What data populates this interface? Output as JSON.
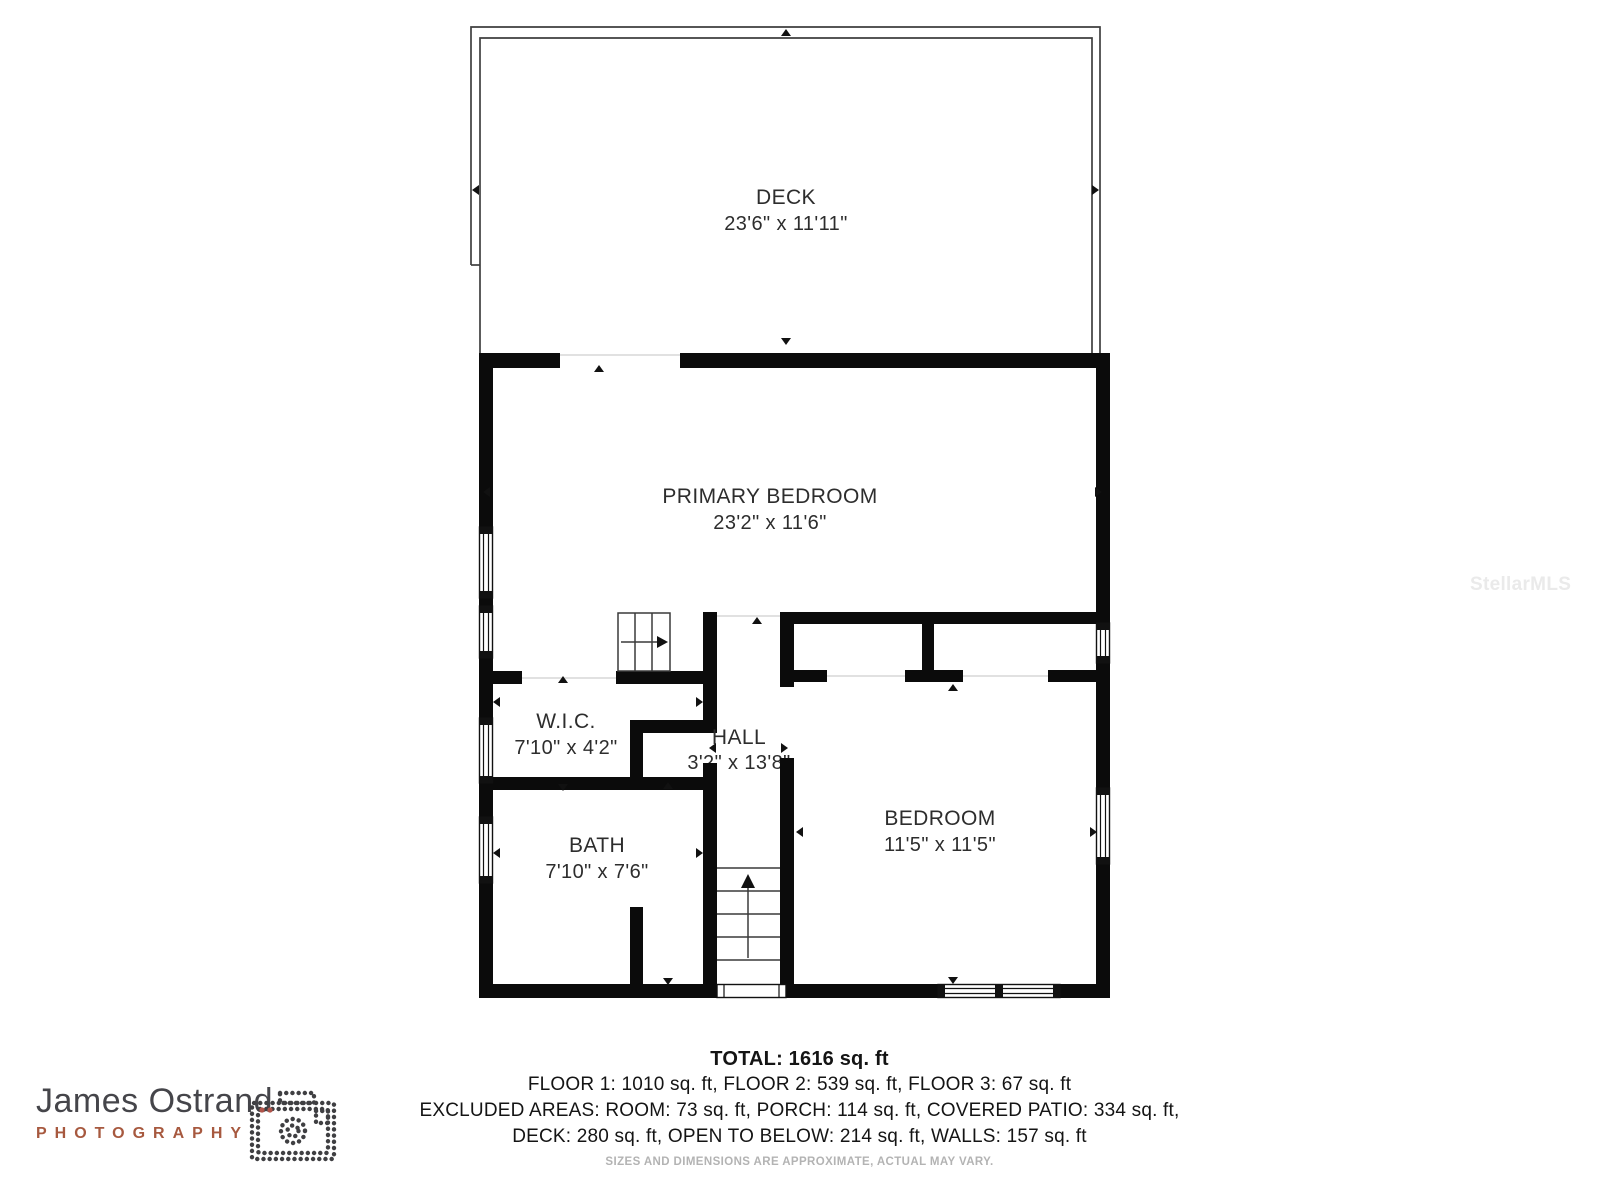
{
  "watermark": "StellarMLS",
  "plan": {
    "wall_color": "#0b0b0b",
    "rooms": [
      {
        "id": "deck",
        "name": "DECK",
        "dims": "23'6\" x 11'11\""
      },
      {
        "id": "primary-bedroom",
        "name": "PRIMARY BEDROOM",
        "dims": "23'2\" x 11'6\""
      },
      {
        "id": "wic",
        "name": "W.I.C.",
        "dims": "7'10\" x 4'2\""
      },
      {
        "id": "hall",
        "name": "HALL",
        "dims": "3'2\" x 13'8\""
      },
      {
        "id": "bath",
        "name": "BATH",
        "dims": "7'10\" x 7'6\""
      },
      {
        "id": "bedroom",
        "name": "BEDROOM",
        "dims": "11'5\" x 11'5\""
      }
    ],
    "icons": [
      "stairs-up-icon",
      "stairs-down-icon",
      "window-icon",
      "door-opening-arrow-icon"
    ]
  },
  "summary": {
    "total": "TOTAL: 1616 sq. ft",
    "floors": "FLOOR 1: 1010 sq. ft, FLOOR 2: 539 sq. ft, FLOOR 3: 67 sq. ft",
    "excluded1": "EXCLUDED AREAS: ROOM: 73 sq. ft, PORCH: 114 sq. ft, COVERED PATIO: 334 sq. ft,",
    "excluded2": "DECK: 280 sq. ft, OPEN TO BELOW: 214 sq. ft, WALLS: 157 sq. ft",
    "disclaimer": "SIZES AND DIMENSIONS ARE APPROXIMATE, ACTUAL MAY VARY."
  },
  "logo": {
    "name": "James Ostrand",
    "subtitle": "PHOTOGRAPHY",
    "name_color": "#45454a",
    "subtitle_color": "#a7593f",
    "icon": "camera-icon"
  }
}
